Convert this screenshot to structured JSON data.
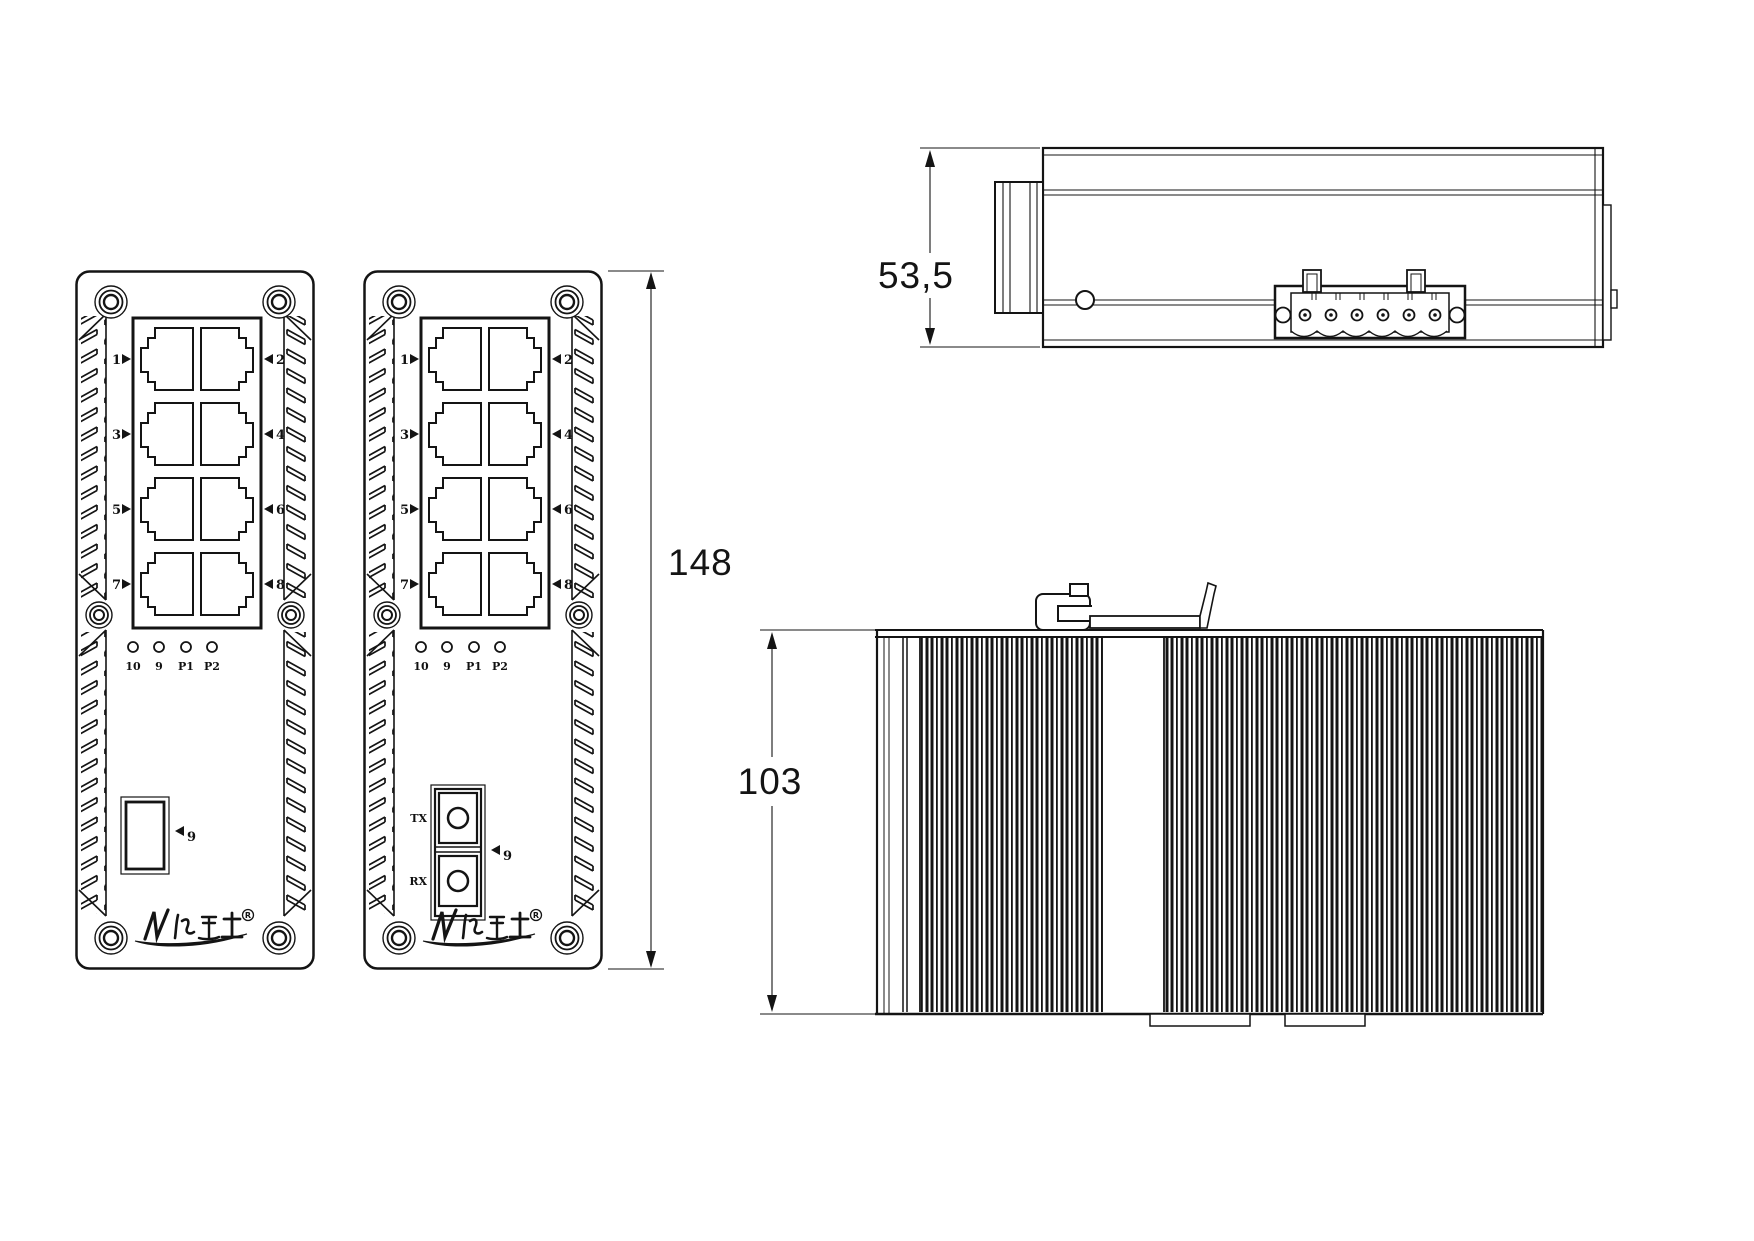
{
  "drawing": {
    "front": {
      "port_labels_left": [
        "1",
        "3",
        "5",
        "7"
      ],
      "port_labels_right": [
        "2",
        "4",
        "6",
        "8"
      ],
      "led_labels": [
        "10",
        "9",
        "P1",
        "P2"
      ],
      "uplink_label": "9",
      "tx": "TX",
      "rx": "RX",
      "reg": "R"
    },
    "dims": {
      "front_height": "148",
      "top_depth": "53,5",
      "side_height": "103"
    },
    "colors": {
      "line": "#141414",
      "background": "#ffffff"
    }
  }
}
